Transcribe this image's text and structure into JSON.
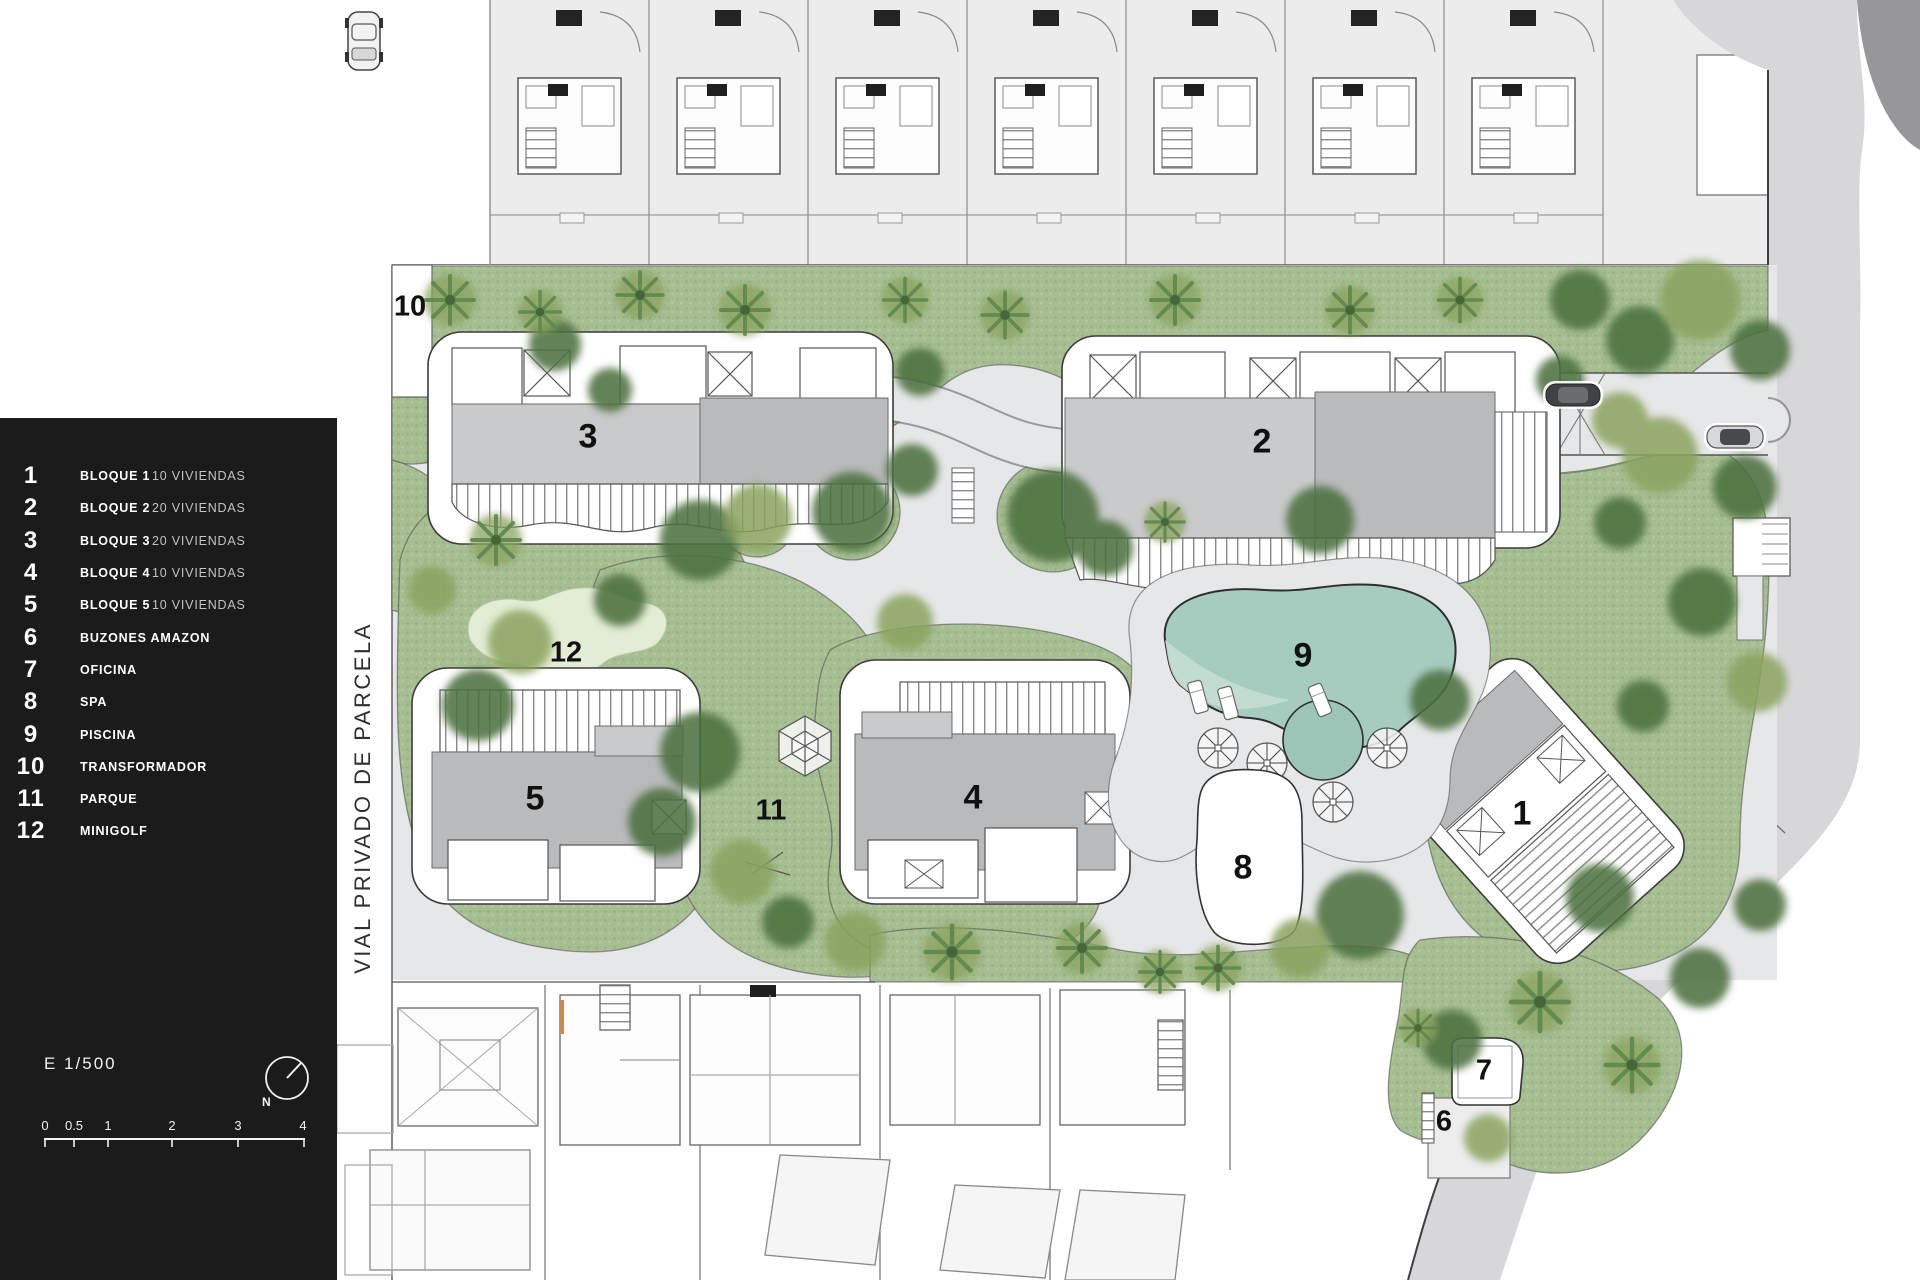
{
  "legend": {
    "items": [
      {
        "num": "1",
        "label": "BLOQUE 1",
        "detail": "10 VIVIENDAS"
      },
      {
        "num": "2",
        "label": "BLOQUE 2",
        "detail": "20 VIVIENDAS"
      },
      {
        "num": "3",
        "label": "BLOQUE 3",
        "detail": "20 VIVIENDAS"
      },
      {
        "num": "4",
        "label": "BLOQUE 4",
        "detail": "10 VIVIENDAS"
      },
      {
        "num": "5",
        "label": "BLOQUE 5",
        "detail": "10 VIVIENDAS"
      },
      {
        "num": "6",
        "label": "BUZONES AMAZON",
        "detail": ""
      },
      {
        "num": "7",
        "label": "OFICINA",
        "detail": ""
      },
      {
        "num": "8",
        "label": "SPA",
        "detail": ""
      },
      {
        "num": "9",
        "label": "PISCINA",
        "detail": ""
      },
      {
        "num": "10",
        "label": "TRANSFORMADOR",
        "detail": ""
      },
      {
        "num": "11",
        "label": "PARQUE",
        "detail": ""
      },
      {
        "num": "12",
        "label": "MINIGOLF",
        "detail": ""
      }
    ],
    "scale_text": "E 1/500",
    "north_label": "N",
    "scale_ticks": [
      "0",
      "0.5",
      "1",
      "2",
      "3",
      "4"
    ]
  },
  "street": {
    "name_vertical": "VIAL PRIVADO DE PARCELA"
  },
  "plan": {
    "labels": [
      "1",
      "2",
      "3",
      "4",
      "5",
      "6",
      "7",
      "8",
      "9",
      "10",
      "11",
      "12"
    ]
  },
  "colors": {
    "legend_bg": "#1b1b1b",
    "grass": "#a6be92",
    "path": "#e6e7e8",
    "roof": "#b9babc",
    "roof_light": "#c9cacb",
    "road": "#d7d7d9",
    "road_dark": "#97979a",
    "pool": "#a6ccc0",
    "pool_light": "#c6ded2",
    "pool_small": "#9cc5b8",
    "minigolf": "#e3ecd4",
    "tree_dark": "#4e7140",
    "tree_olive": "#8aa35e",
    "strip": "#ececec"
  }
}
